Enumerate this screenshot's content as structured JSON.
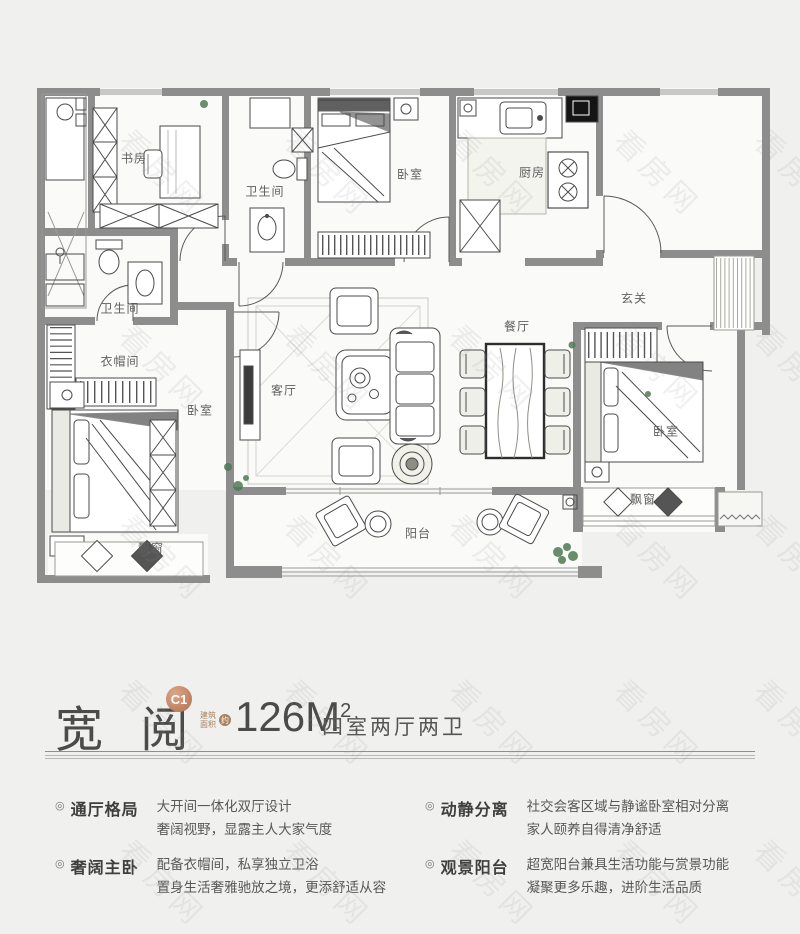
{
  "watermark": {
    "text": "看房网"
  },
  "plan": {
    "rooms": [
      {
        "id": "study",
        "label": "书房",
        "x": 134,
        "y": 158
      },
      {
        "id": "bath-top",
        "label": "卫生间",
        "x": 265,
        "y": 191
      },
      {
        "id": "bedroom-top",
        "label": "卧室",
        "x": 410,
        "y": 174
      },
      {
        "id": "kitchen",
        "label": "厨房",
        "x": 532,
        "y": 172
      },
      {
        "id": "foyer",
        "label": "玄关",
        "x": 634,
        "y": 298
      },
      {
        "id": "dining",
        "label": "餐厅",
        "x": 517,
        "y": 326
      },
      {
        "id": "living",
        "label": "客厅",
        "x": 284,
        "y": 390
      },
      {
        "id": "bath-master",
        "label": "卫生间",
        "x": 120,
        "y": 308
      },
      {
        "id": "cloakroom",
        "label": "衣帽间",
        "x": 120,
        "y": 361
      },
      {
        "id": "bedroom-master",
        "label": "卧室",
        "x": 200,
        "y": 410
      },
      {
        "id": "bedroom-right",
        "label": "卧室",
        "x": 666,
        "y": 431
      },
      {
        "id": "balcony",
        "label": "阳台",
        "x": 418,
        "y": 533
      },
      {
        "id": "baywindow-left",
        "label": "飘窗",
        "x": 151,
        "y": 548
      },
      {
        "id": "baywindow-right",
        "label": "飘窗",
        "x": 643,
        "y": 499
      }
    ]
  },
  "info": {
    "name": "宽 阅",
    "badge": "C1",
    "area_note_line1": "建筑",
    "area_note_line2": "面积",
    "area_note_circle": "约",
    "area_value": "126M",
    "area_sup": "2",
    "layout": "四室两厅两卫"
  },
  "feature_bullet": "◎",
  "features": [
    {
      "title": "通厅格局",
      "line1": "大开间一体化双厅设计",
      "line2": "奢阔视野，显露主人大家气度"
    },
    {
      "title": "动静分离",
      "line1": "社交会客区域与静谧卧室相对分离",
      "line2": "家人颐养自得清净舒适"
    },
    {
      "title": "奢阔主卧",
      "line1": "配备衣帽间，私享独立卫浴",
      "line2": "置身生活奢雅驰放之境，更添舒适从容"
    },
    {
      "title": "观景阳台",
      "line1": "超宽阳台兼具生活功能与赏景功能",
      "line2": "凝聚更多乐趣，进阶生活品质"
    }
  ]
}
